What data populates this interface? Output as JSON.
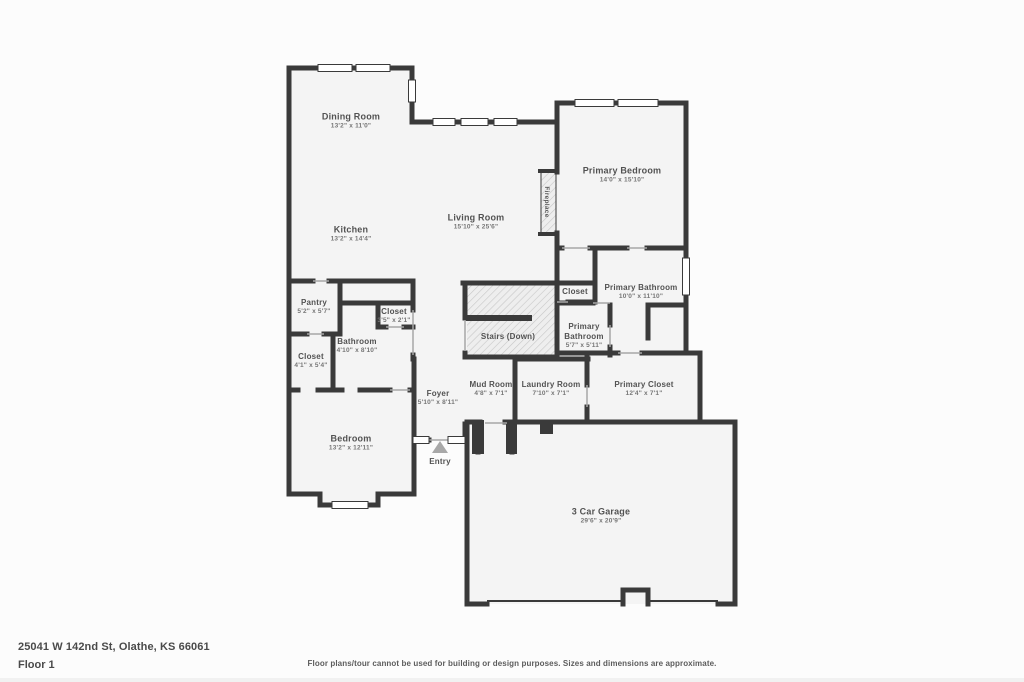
{
  "footer": {
    "address": "25041 W 142nd St, Olathe, KS 66061",
    "floor_label": "Floor 1",
    "disclaimer": "Floor plans/tour cannot be used for building or design purposes. Sizes and dimensions are approximate."
  },
  "colors": {
    "wall": "#3a3a3a",
    "room_fill": "#f4f4f4",
    "page_background": "#fcfcfc",
    "room_name_text": "#525252",
    "dims_text": "#767676",
    "hatch_line": "#c7c7c7",
    "entry_marker": "#a8a8a8"
  },
  "rooms": {
    "dining_room": {
      "name": "Dining Room",
      "dims": "13'2\" x 11'0\""
    },
    "kitchen": {
      "name": "Kitchen",
      "dims": "13'2\" x 14'4\""
    },
    "living_room": {
      "name": "Living Room",
      "dims": "15'10\" x 25'6\""
    },
    "primary_bedroom": {
      "name": "Primary Bedroom",
      "dims": "14'0\" x 15'10\""
    },
    "fireplace": {
      "name": "Fireplace"
    },
    "closet_hall": {
      "name": "Closet"
    },
    "primary_bathroom": {
      "name": "Primary Bathroom",
      "dims": "10'0\" x 11'10\""
    },
    "primary_bathroom_small": {
      "name_lines": [
        "Primary",
        "Bathroom"
      ],
      "dims": "5'7\" x 5'11\""
    },
    "stairs": {
      "name": "Stairs (Down)"
    },
    "pantry": {
      "name": "Pantry",
      "dims": "5'2\" x 5'7\""
    },
    "closet_small": {
      "name": "Closet",
      "dims": "3'5\" x 2'1\""
    },
    "bathroom": {
      "name": "Bathroom",
      "dims": "4'10\" x 8'10\""
    },
    "closet_left": {
      "name": "Closet",
      "dims": "4'1\" x 5'4\""
    },
    "foyer": {
      "name": "Foyer",
      "dims": "5'10\" x 8'11\""
    },
    "mud_room": {
      "name": "Mud Room",
      "dims": "4'8\" x 7'1\""
    },
    "laundry_room": {
      "name": "Laundry Room",
      "dims": "7'10\" x 7'1\""
    },
    "primary_closet": {
      "name": "Primary Closet",
      "dims": "12'4\" x 7'1\""
    },
    "bedroom": {
      "name": "Bedroom",
      "dims": "13'2\" x 12'11\""
    },
    "entry": {
      "name": "Entry"
    },
    "garage": {
      "name": "3 Car Garage",
      "dims": "29'6\" x 20'9\""
    }
  }
}
